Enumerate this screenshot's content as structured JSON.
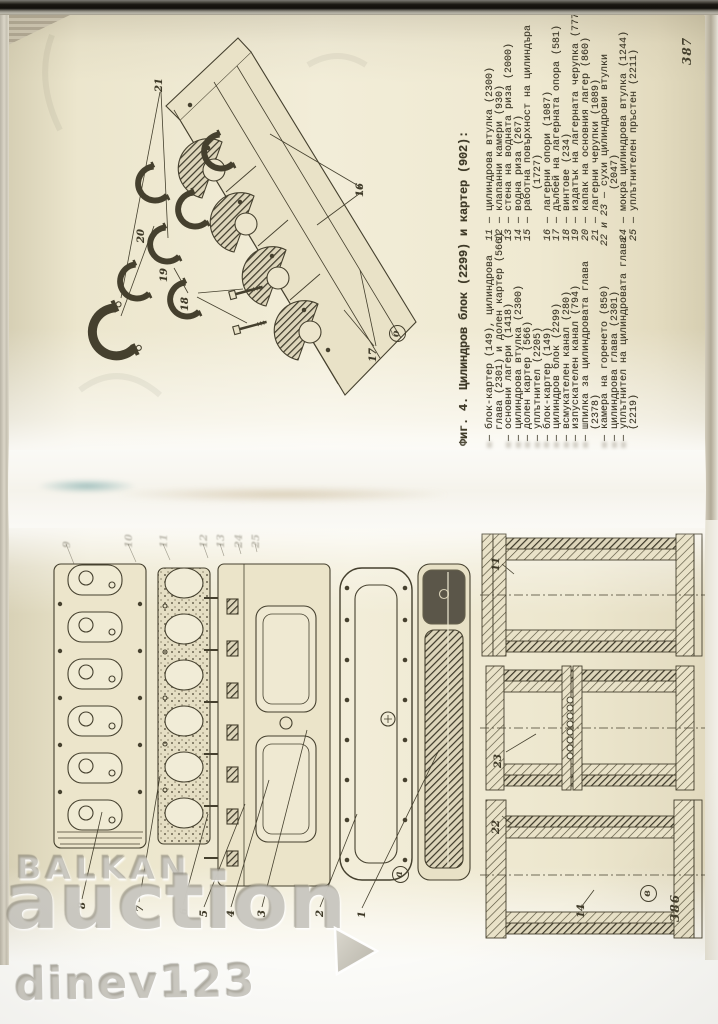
{
  "page_387": {
    "folio": "387",
    "caption": "Фиг. 4. Цилиндров блок (2299) и картер (902):",
    "subfigure_label": "б",
    "figure_callouts": [
      "21",
      "20",
      "19",
      "18",
      "16",
      "17"
    ],
    "legend_col1": [
      {
        "text": "блок-картер (149), цилиндрова",
        "start": true
      },
      {
        "text": "глава (2301) и долен картер (566)",
        "start": false
      },
      {
        "text": "основни лагери (1418)",
        "start": true
      },
      {
        "text": "цилиндрова втулка (2300)",
        "start": true
      },
      {
        "text": "долен картер (566)",
        "start": true
      },
      {
        "text": "уплътнител (2205)",
        "start": true
      },
      {
        "text": "блок-картер (149)",
        "start": true
      },
      {
        "text": "цилиндров блок (2299)",
        "start": true
      },
      {
        "text": "всмукателен канал (280)",
        "start": true
      },
      {
        "text": "изпускателен канал (794)",
        "start": true
      },
      {
        "text": "шпилка за цилиндровата глава",
        "start": true
      },
      {
        "text": "(2378)",
        "start": false
      },
      {
        "text": "камера на горенето (850)",
        "start": true
      },
      {
        "text": "цилиндрова глава (2301)",
        "start": true
      },
      {
        "text": "уплътнител на цилиндровата глава",
        "start": true
      },
      {
        "text": "(2219)",
        "start": false
      }
    ],
    "legend_col2": [
      {
        "num": "11",
        "text": "цилиндрова втулка (2300)"
      },
      {
        "num": "12",
        "text": "клапанни камери (930)"
      },
      {
        "num": "13",
        "text": "стена на водната риза (2000)"
      },
      {
        "num": "14",
        "text": "водна риза (267)"
      },
      {
        "num": "15",
        "text": "работна повърхност на цилиндъра"
      },
      {
        "num": "",
        "text": "(1727)"
      },
      {
        "num": "16",
        "text": "лагерни опори (1087)"
      },
      {
        "num": "17",
        "text": "дълбей на лагерната опора (581)"
      },
      {
        "num": "18",
        "text": "винтове (234)"
      },
      {
        "num": "19",
        "text": "издатък на лагерната черупка (777)"
      },
      {
        "num": "20",
        "text": "капак на основния лагер (860)"
      },
      {
        "num": "21",
        "text": "лагерни черупки (1089)"
      },
      {
        "num": "22 и 23",
        "text": "сухи цилиндрови втулки"
      },
      {
        "num": "",
        "text": "(2047)"
      },
      {
        "num": "24",
        "text": "мокра цилиндрова втулка (1244)"
      },
      {
        "num": "25",
        "text": "уплътнителен пръстен (2211)"
      }
    ]
  },
  "page_386": {
    "folio": "386",
    "subfigure_label_a": "а",
    "subfigure_label_v": "в",
    "figure_a_callouts_left": [
      "8",
      "7",
      "6",
      "5",
      "4",
      "3",
      "2",
      "1"
    ],
    "figure_a_callouts_faint": [
      "9",
      "10",
      "11",
      "12",
      "13",
      "24",
      "25"
    ],
    "figure_v_callouts": [
      "11",
      "23",
      "22",
      "14"
    ]
  },
  "watermark": {
    "line1": "BALKAN",
    "line2": "auction",
    "line3": "dinev123",
    "arrow_icon": "right-arrow",
    "color": "#a39e92"
  }
}
